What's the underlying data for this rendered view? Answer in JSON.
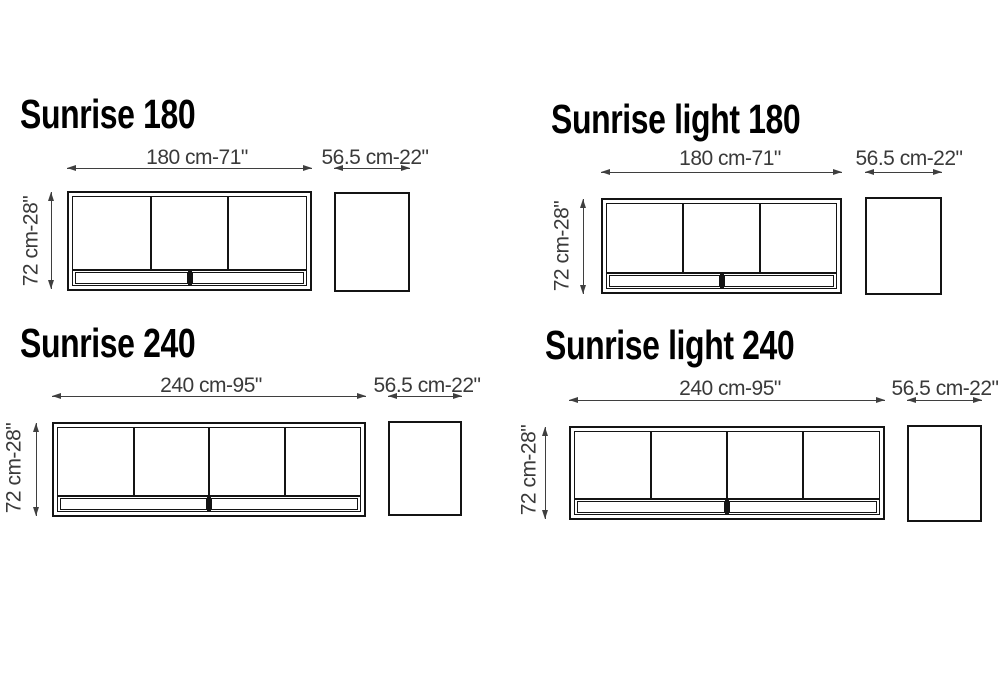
{
  "page": {
    "background": "#ffffff",
    "description": "Furniture dimension spec sheet with four sideboard variants"
  },
  "colors": {
    "drawing_line": "#141414",
    "dimension_line": "#3f3f3f",
    "dimension_text": "#3a3a3a",
    "title_text": "#000000"
  },
  "variants": [
    {
      "id": "sunrise-180",
      "title": "Sunrise 180",
      "width_label": "180 cm-71\"",
      "depth_label": "56.5 cm-22\"",
      "height_label": "72 cm-28\"",
      "doors": 3,
      "base_compartments": 2
    },
    {
      "id": "sunrise-light-180",
      "title": "Sunrise light 180",
      "width_label": "180 cm-71\"",
      "depth_label": "56.5 cm-22\"",
      "height_label": "72 cm-28\"",
      "doors": 3,
      "base_compartments": 2
    },
    {
      "id": "sunrise-240",
      "title": "Sunrise 240",
      "width_label": "240 cm-95\"",
      "depth_label": "56.5 cm-22\"",
      "height_label": "72 cm-28\"",
      "doors": 4,
      "base_compartments": 2
    },
    {
      "id": "sunrise-light-240",
      "title": "Sunrise light 240",
      "width_label": "240 cm-95\"",
      "depth_label": "56.5 cm-22\"",
      "height_label": "72 cm-28\"",
      "doors": 4,
      "base_compartments": 2
    }
  ]
}
